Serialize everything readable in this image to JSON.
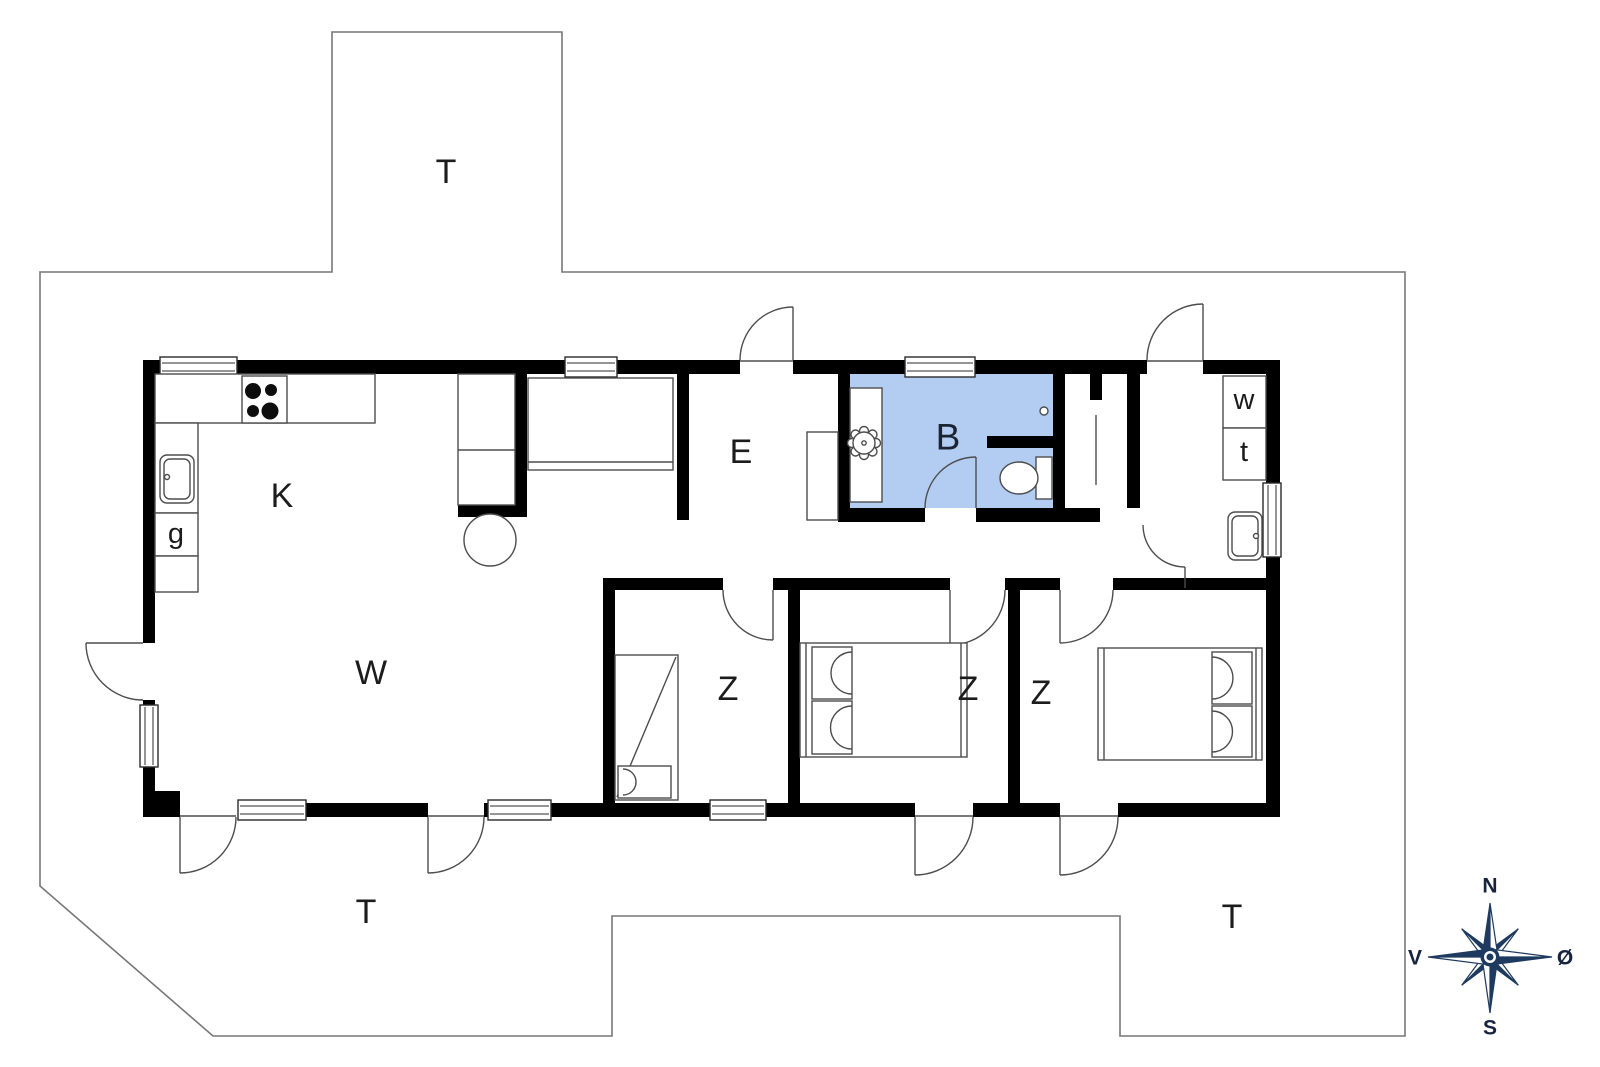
{
  "plan": {
    "type": "house-floor-plan",
    "background_color": "#ffffff",
    "wall_color": "#000000",
    "bathroom_fill_color": "#b3cdf2",
    "terrace_outline_color": "#777777",
    "fixture_line_color": "#4d4d4d",
    "label_color": "#1c1c1c",
    "compass_color": "#1e3a5f"
  },
  "labels": {
    "terrace_top": "T",
    "terrace_bottom_left": "T",
    "terrace_bottom_right": "T",
    "kitchen": "K",
    "closet_g": "g",
    "living_room": "W",
    "entrance": "E",
    "bathroom": "B",
    "bedroom_1": "Z",
    "bedroom_2": "Z",
    "bedroom_3": "Z",
    "washer": "w",
    "dryer": "t"
  },
  "compass": {
    "north": "N",
    "south": "S",
    "west": "V",
    "east": "Ø"
  },
  "symbols": {
    "stove": "cooktop-4-burners",
    "kitchen_sink": "single-basin-sink",
    "bathroom_sink": "round-scalloped-basin",
    "toilet": "toilet-with-cistern",
    "floor_drain": "floor-drain",
    "utility_sink": "single-basin-sink",
    "washer_box": "washing-machine",
    "dryer_box": "tumble-dryer",
    "bunk_bed": "bunk-bed-with-ladder",
    "double_bed_left": "double-bed-pillows-west",
    "double_bed_right": "double-bed-pillows-east",
    "stool": "round-stool"
  }
}
